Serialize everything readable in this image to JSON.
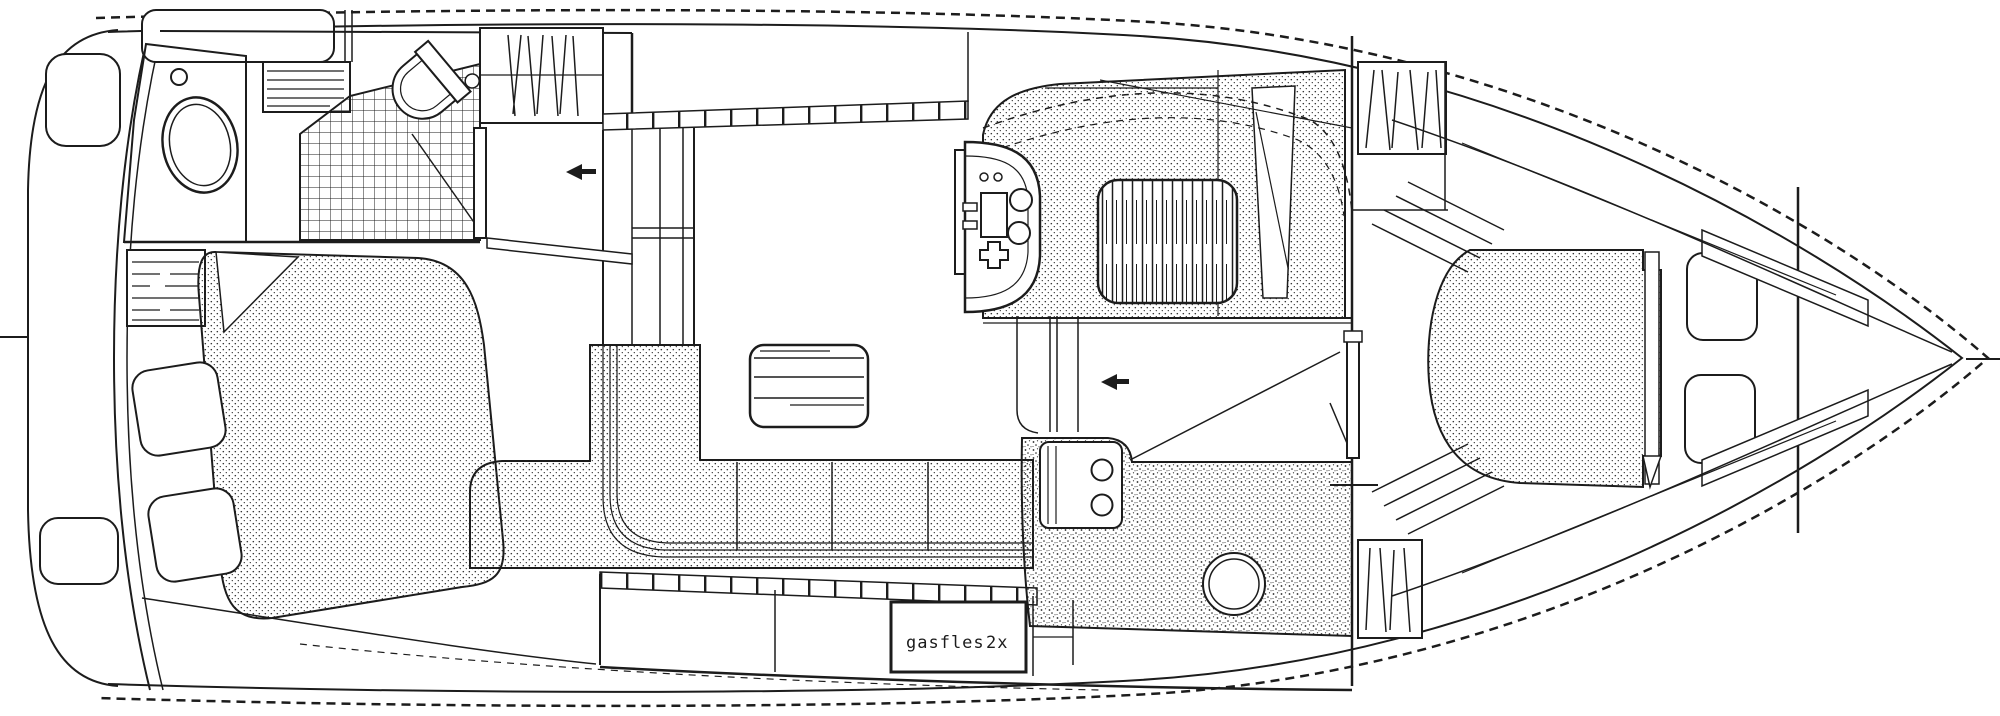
{
  "drawing": {
    "kind": "yacht-deck-plan-line-drawing",
    "orientation": "bow-right",
    "ink_color": "#1c1c1c",
    "paper_color": "#ffffff"
  },
  "labels": {
    "gas_locker": {
      "text": "gasfles",
      "count": "2x"
    }
  },
  "icons": {
    "arrows": [
      {
        "name": "entry-arrow-aft-companionway",
        "direction": "left"
      },
      {
        "name": "entry-arrow-galley-companionway",
        "direction": "left"
      }
    ]
  }
}
